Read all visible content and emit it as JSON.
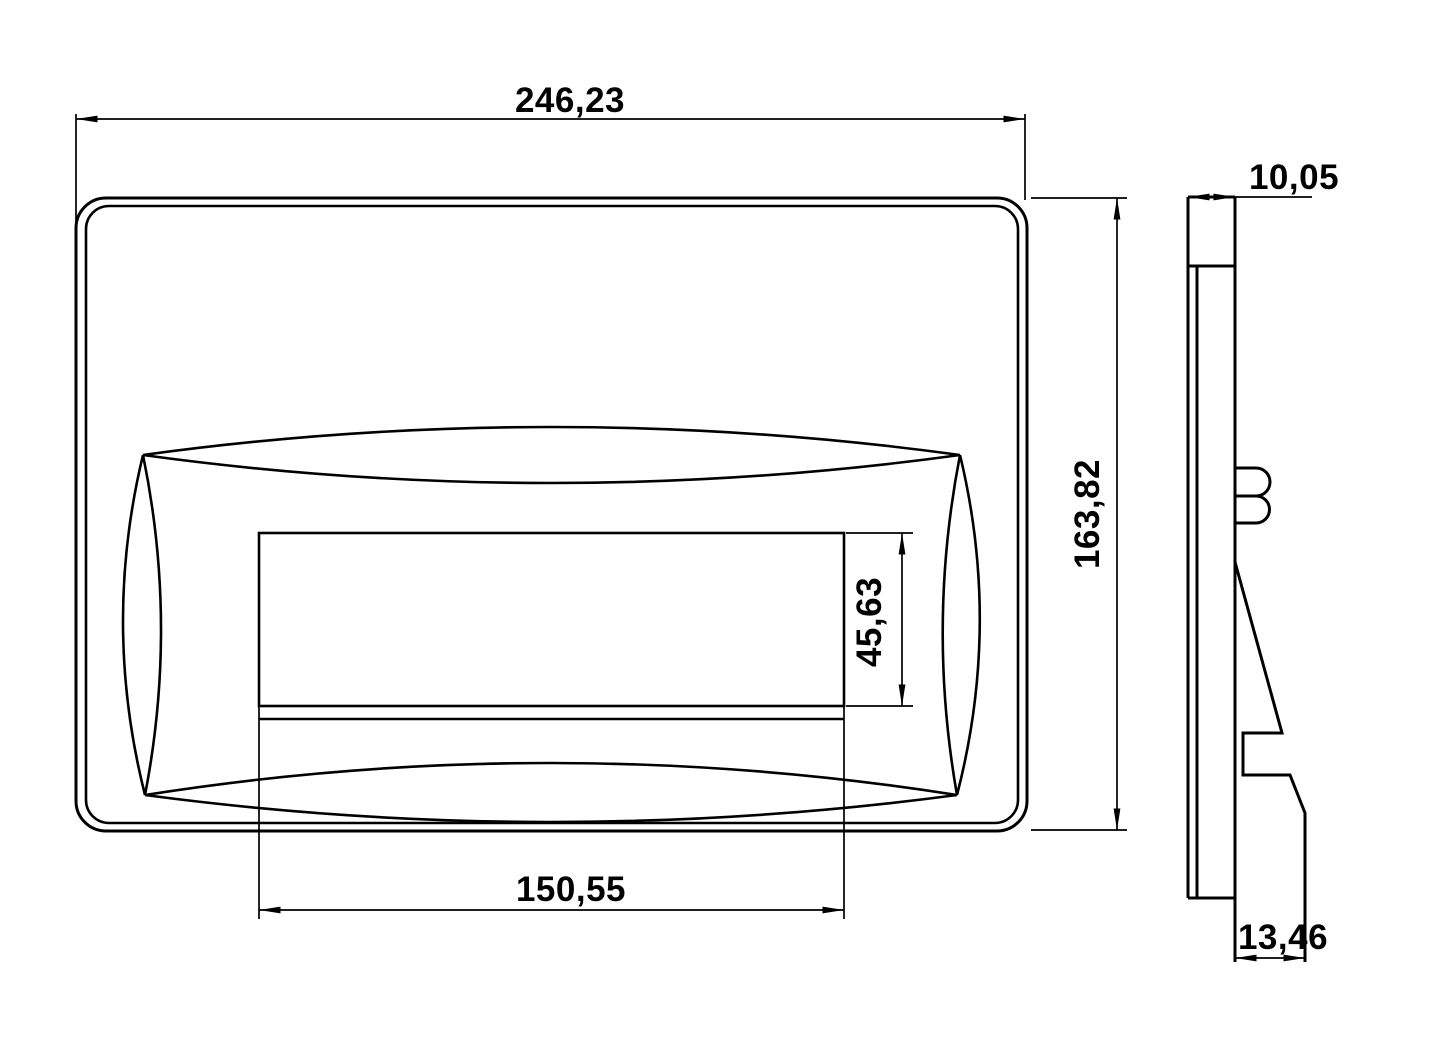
{
  "colors": {
    "background": "#ffffff",
    "line": "#000000"
  },
  "dimensions": {
    "overall_width": "246,23",
    "overall_height": "163,82",
    "button_width": "150,55",
    "button_height": "45,63",
    "plate_thickness": "10,05",
    "bottom_depth": "13,46"
  }
}
